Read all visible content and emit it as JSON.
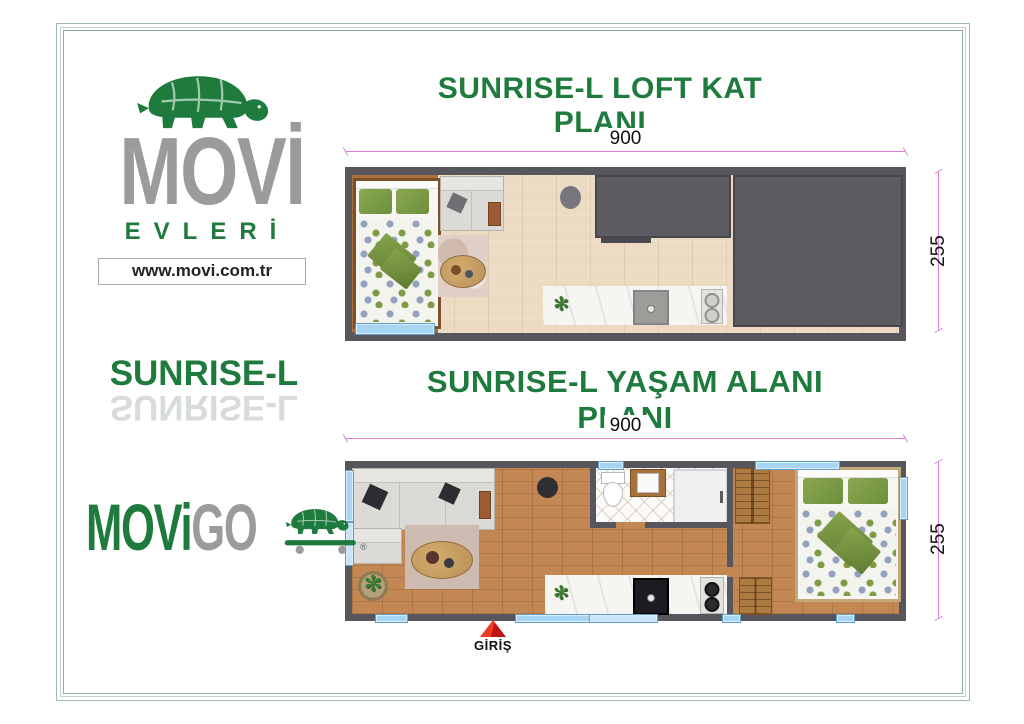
{
  "brand": {
    "name": "MOVİ",
    "subtitle": "EVLERİ",
    "website": "www.movi.com.tr"
  },
  "model_name": "SUNRISE-L",
  "loft_plan": {
    "title": "SUNRISE-L LOFT KAT PLANI",
    "width_label": "900",
    "height_label": "255"
  },
  "living_plan": {
    "title": "SUNRISE-L YAŞAM ALANI PLANI",
    "width_label": "900",
    "height_label": "255",
    "entrance_label": "GİRİŞ"
  },
  "footer_brand": {
    "part1": "MOVi",
    "part2": "GO",
    "registered_mark": "®"
  },
  "colors": {
    "brand_green": "#1f7a3e",
    "logo_gray": "#9b9b9b",
    "dimension_pink": "#df7fd9",
    "wall_gray": "#57565c",
    "window_blue": "#a6d4f2",
    "entrance_red": "#e01f1f"
  }
}
